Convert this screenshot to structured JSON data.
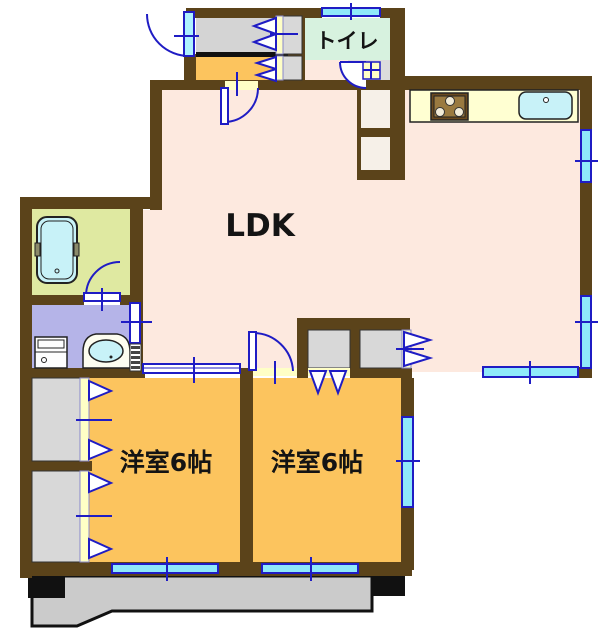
{
  "plan": {
    "type": "japanese-apartment-floor-plan",
    "rooms": {
      "ldk": {
        "label": "LDK",
        "color": "#fde9df"
      },
      "toilet": {
        "label": "トイレ",
        "color": "#d7f2df"
      },
      "bedroom_left": {
        "label": "洋室6帖",
        "color": "#fcc45e"
      },
      "bedroom_right": {
        "label": "洋室6帖",
        "color": "#fcc45e"
      },
      "bathroom": {
        "color": "#dfe9a1"
      },
      "washroom": {
        "color": "#b5b4e8"
      },
      "entrance_hall": {
        "color": "#d4d4d4"
      },
      "entrance_flooring": {
        "color": "#fcc45e"
      },
      "balcony": {
        "color": "#cbcbcb"
      },
      "closet": {
        "color": "#d8d8d8"
      }
    },
    "fixtures": [
      "bathtub",
      "washbasin",
      "washer-space",
      "gas-stove",
      "kitchen-sink",
      "kitchen-counter"
    ],
    "colors": {
      "wall": "#5b431a",
      "window_glass": "#8fe9fa",
      "window_frame": "#1f1cc4",
      "door_line": "#1f1cc4",
      "door_strip": "#ffffc6",
      "kitchen_counter": "#ffffd2",
      "water_fixture": "#c8f2f8",
      "step_line": "#111111",
      "balcony_outline": "#111111"
    }
  }
}
